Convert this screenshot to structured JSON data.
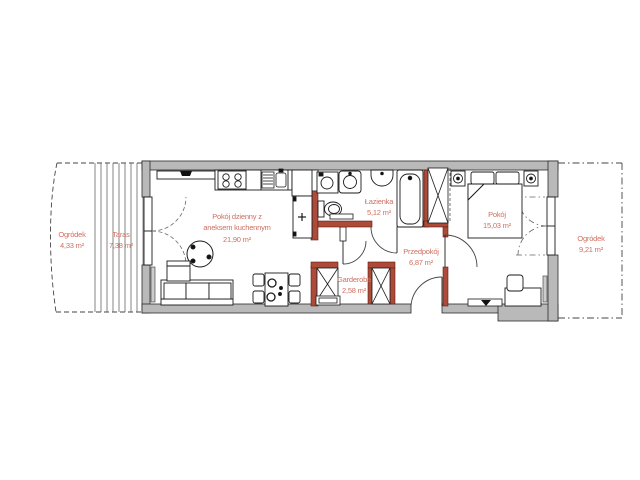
{
  "plan_title": "apartment-floor-plan",
  "colors": {
    "label_text": "#cf6f60",
    "accent_wall": "#ad4a38",
    "exterior_wall": "#b9b9b9"
  },
  "rooms": {
    "garden_left": {
      "name": "Ogródek",
      "area": "4,33 m²"
    },
    "terrace": {
      "name": "Taras",
      "area": "7,38 m²"
    },
    "living": {
      "name_line1": "Pokój dzienny z",
      "name_line2": "aneksem kuchennym",
      "area": "21,90 m²"
    },
    "bathroom": {
      "name": "Łazienka",
      "area": "5,12 m²"
    },
    "hallway": {
      "name": "Przedpokój",
      "area": "6,87 m²"
    },
    "wardrobe": {
      "name": "Garderoba",
      "area": "2,58 m²"
    },
    "bedroom": {
      "name": "Pokój",
      "area": "15,03 m²"
    },
    "garden_right": {
      "name": "Ogródek",
      "area": "9,21 m²"
    }
  }
}
